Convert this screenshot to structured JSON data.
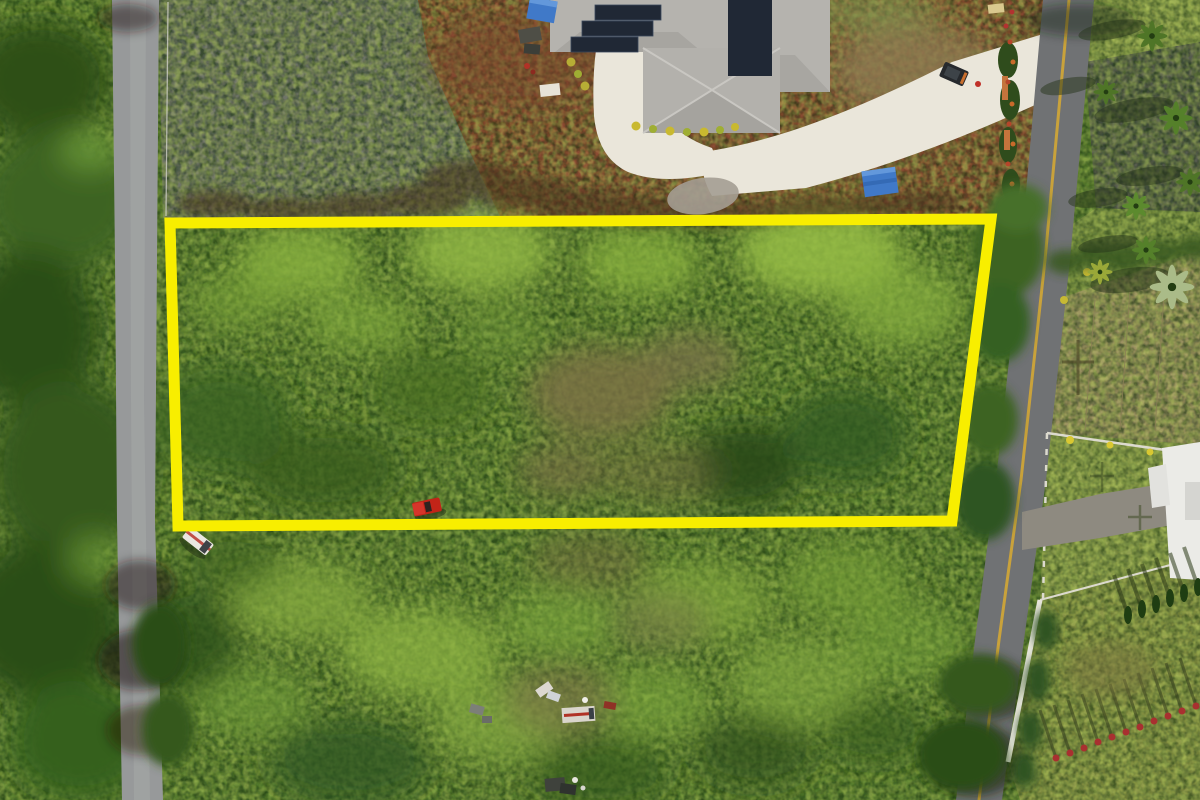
{
  "meta": {
    "title": "Aerial drone photograph of a rectangular vacant land parcel outlined in yellow, bordered by two rural roads, with a solar-roofed house above and landscaped tropical properties to the east",
    "image_type": "aerial-photograph",
    "visible_text": "none"
  },
  "scene": {
    "property_boundary": {
      "shape": "rectangle",
      "outline_color_name": "bright yellow",
      "contents": "dense green and brown brush with one red pickup truck inside"
    },
    "elements": [
      {
        "name": "property-boundary-overlay",
        "label": "Yellow surveyed lot outline annotation"
      },
      {
        "name": "vacant-lot-brush",
        "label": "Overgrown vacant lot inside the boundary"
      },
      {
        "name": "solar-house",
        "label": "Neighboring house with rooftop solar panels"
      },
      {
        "name": "concrete-driveway",
        "label": "White concrete driveway curving to the east road"
      },
      {
        "name": "left-road",
        "label": "Narrow paved road along the west side"
      },
      {
        "name": "right-road",
        "label": "Paved road with yellow centerline along the east side"
      },
      {
        "name": "rocky-clearing",
        "label": "Gray cinder rock cleared strip above the lot"
      },
      {
        "name": "red-dirt-clearing",
        "label": "Red volcanic dirt yard around the house"
      },
      {
        "name": "blue-tarp",
        "label": "Blue tarps near the house"
      },
      {
        "name": "red-pickup-truck",
        "label": "Red pickup truck parked in the brush"
      },
      {
        "name": "white-pickup-truck",
        "label": "White truck parked below the lower boundary"
      },
      {
        "name": "black-utility-vehicle",
        "label": "Dark utility vehicle on the driveway"
      },
      {
        "name": "debris-cluster",
        "label": "Abandoned vehicles and debris in the lower brush"
      },
      {
        "name": "palm-trees",
        "label": "Palm trees and tropical landscaping east of the road"
      },
      {
        "name": "white-roof-house",
        "label": "White-roofed house at the right edge"
      },
      {
        "name": "red-shrub-row",
        "label": "Diagonal row of red shrubs with long shadows, lower right"
      },
      {
        "name": "tan-field",
        "label": "Dry tan field east of the road"
      }
    ]
  },
  "colors": {
    "veg_base": "#55792e",
    "rocky_ground": "#6f7368",
    "red_dirt": "#8b4b33",
    "dry_grass": "#8d7a52",
    "roof_gray": "#b5b3ae",
    "roof_gray_shade": "#a6a49f",
    "solar_panel": "#202835",
    "driveway_concrete": "#eae6da",
    "gravel": "#a49d92",
    "left_road": "#97999a",
    "right_road": "#707274",
    "road_centerline": "#c9a23b",
    "boundary_yellow": "#f8ee00",
    "tarp_blue": "#4079c8",
    "truck_red": "#c22418",
    "truck_white": "#eae7e0",
    "suv_black": "#26292d",
    "white_roof": "#ebebe7",
    "fence_white": "#dcdacе",
    "fence_light": "#dcdace",
    "tan_field": "#9c9063",
    "field_green": "#8a9448",
    "lawn_green": "#90a050",
    "dark_pad": "#565a4e",
    "shrub_red": "#a83030",
    "palm_green": "#4f7527",
    "shadow": "#2c2415"
  }
}
